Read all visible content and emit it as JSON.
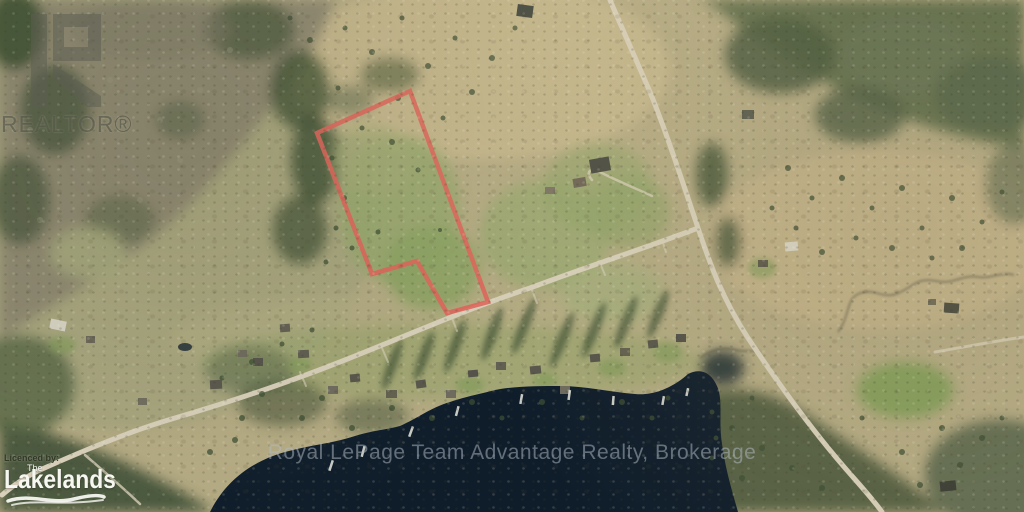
{
  "branding": {
    "realtor_logo_text": "REALTOR®",
    "lakelands_licensed_by": "Licenced by:",
    "lakelands_the": "The",
    "lakelands_name": "Lakelands",
    "brokerage_watermark": "Royal LePage Team Advantage Realty, Brokerage"
  },
  "property": {
    "boundary_color": "#e0635a",
    "boundary_points": "410,91 317,133 372,274 417,261 447,313 488,302"
  },
  "scene": {
    "lake_color": "#0f1d2b",
    "road_color": "#d8d0ba",
    "field_tan": "#b5ab84",
    "field_green": "#93a36b",
    "forest_green": "#4e5c3f",
    "woods_brown": "#8a8470"
  }
}
